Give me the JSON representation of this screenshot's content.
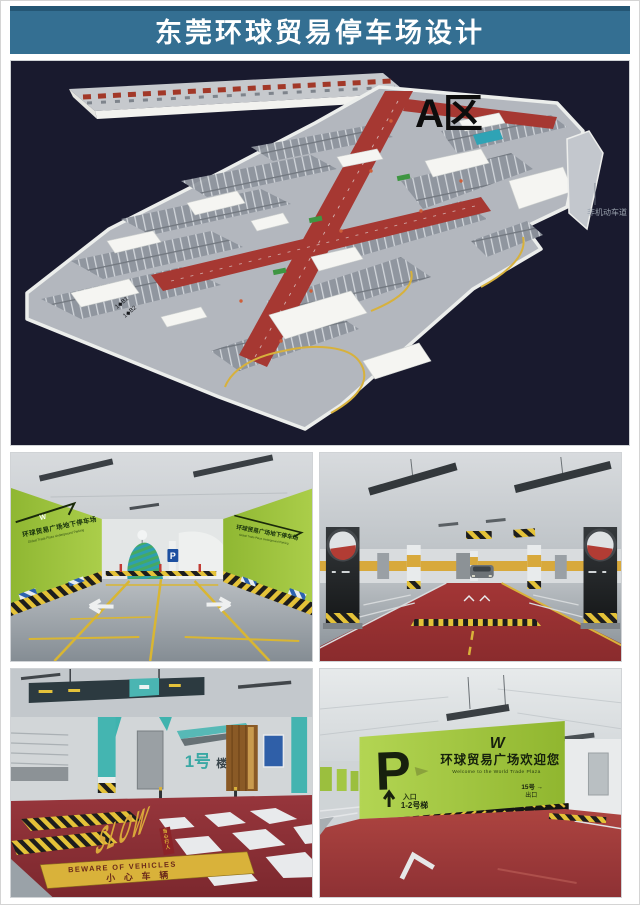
{
  "header": {
    "title": "东莞环球贸易停车场设计"
  },
  "plan": {
    "zone_label": "A区",
    "lane_annotation": "非机动车道",
    "ramp_labels": [
      "1◆B1",
      "1◆B2"
    ]
  },
  "photos": {
    "entrance": {
      "wall_cn": "环球贸易广场地下停车场",
      "wall_en": "Global Trade Plaza Underground Parking",
      "logo": "W",
      "pillar_sign": "P"
    },
    "crosswalk": {
      "building_sign_no": "1号",
      "building_sign_suffix": "楼",
      "floor_marking": "SLOW",
      "crossing_caption": [
        "当",
        "心",
        "行",
        "人"
      ],
      "banner_en": "BEWARE OF VEHICLES",
      "banner_cn": "小心车辆"
    },
    "welcome": {
      "big_letter": "P",
      "logo": "W",
      "welcome_cn": "环球贸易广场欢迎您",
      "welcome_en": "Welcome to the World Trade Plaza",
      "entrance_label": "入口",
      "entrance_no": "1-2号梯",
      "exit_no": "15号 →",
      "exit_label": "出口"
    }
  },
  "colors": {
    "header_bg": "#346f92",
    "plan_bg": "#191a2e",
    "road_red": "#a63832",
    "marking_yellow": "#d9b23c",
    "signage_green": "#a5cc43",
    "teal_accent": "#45b5b1",
    "floor_red": "#8e3134"
  }
}
